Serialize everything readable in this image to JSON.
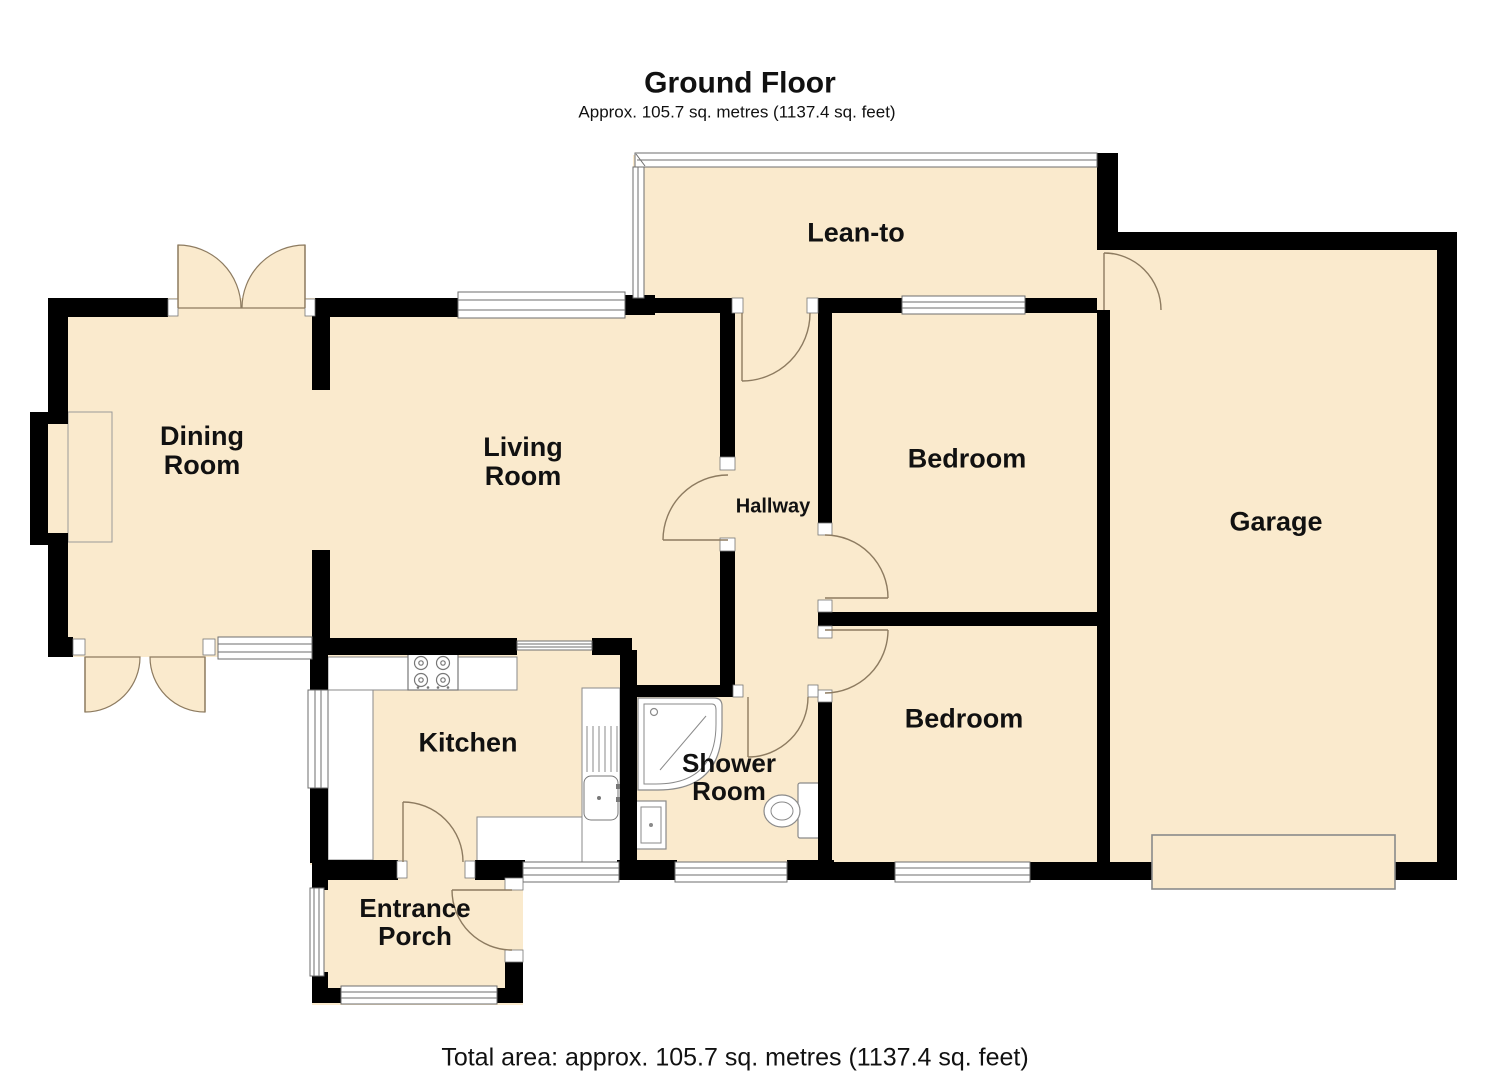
{
  "header": {
    "title": "Ground Floor",
    "subtitle": "Approx. 105.7 sq. metres (1137.4 sq. feet)"
  },
  "footer": {
    "total_area": "Total area: approx. 105.7 sq. metres (1137.4 sq. feet)"
  },
  "rooms": {
    "dining": {
      "line1": "Dining",
      "line2": "Room"
    },
    "living": {
      "line1": "Living",
      "line2": "Room"
    },
    "leanto": {
      "label": "Lean-to"
    },
    "bedroom1": {
      "label": "Bedroom"
    },
    "garage": {
      "label": "Garage"
    },
    "hallway": {
      "label": "Hallway"
    },
    "bedroom2": {
      "label": "Bedroom"
    },
    "kitchen": {
      "label": "Kitchen"
    },
    "shower": {
      "line1": "Shower",
      "line2": "Room"
    },
    "porch": {
      "line1": "Entrance",
      "line2": "Porch"
    }
  },
  "colors": {
    "floor": "#faeacd",
    "wall": "#000000",
    "window_line": "#6e6e6e",
    "door_arc": "#8d7b60",
    "fixture_line": "#8a8a8a"
  },
  "fixtures": [
    "hob",
    "kitchen-counter",
    "kitchen-sink",
    "shower-tray",
    "wash-basin",
    "toilet",
    "garage-door",
    "fireplace"
  ]
}
